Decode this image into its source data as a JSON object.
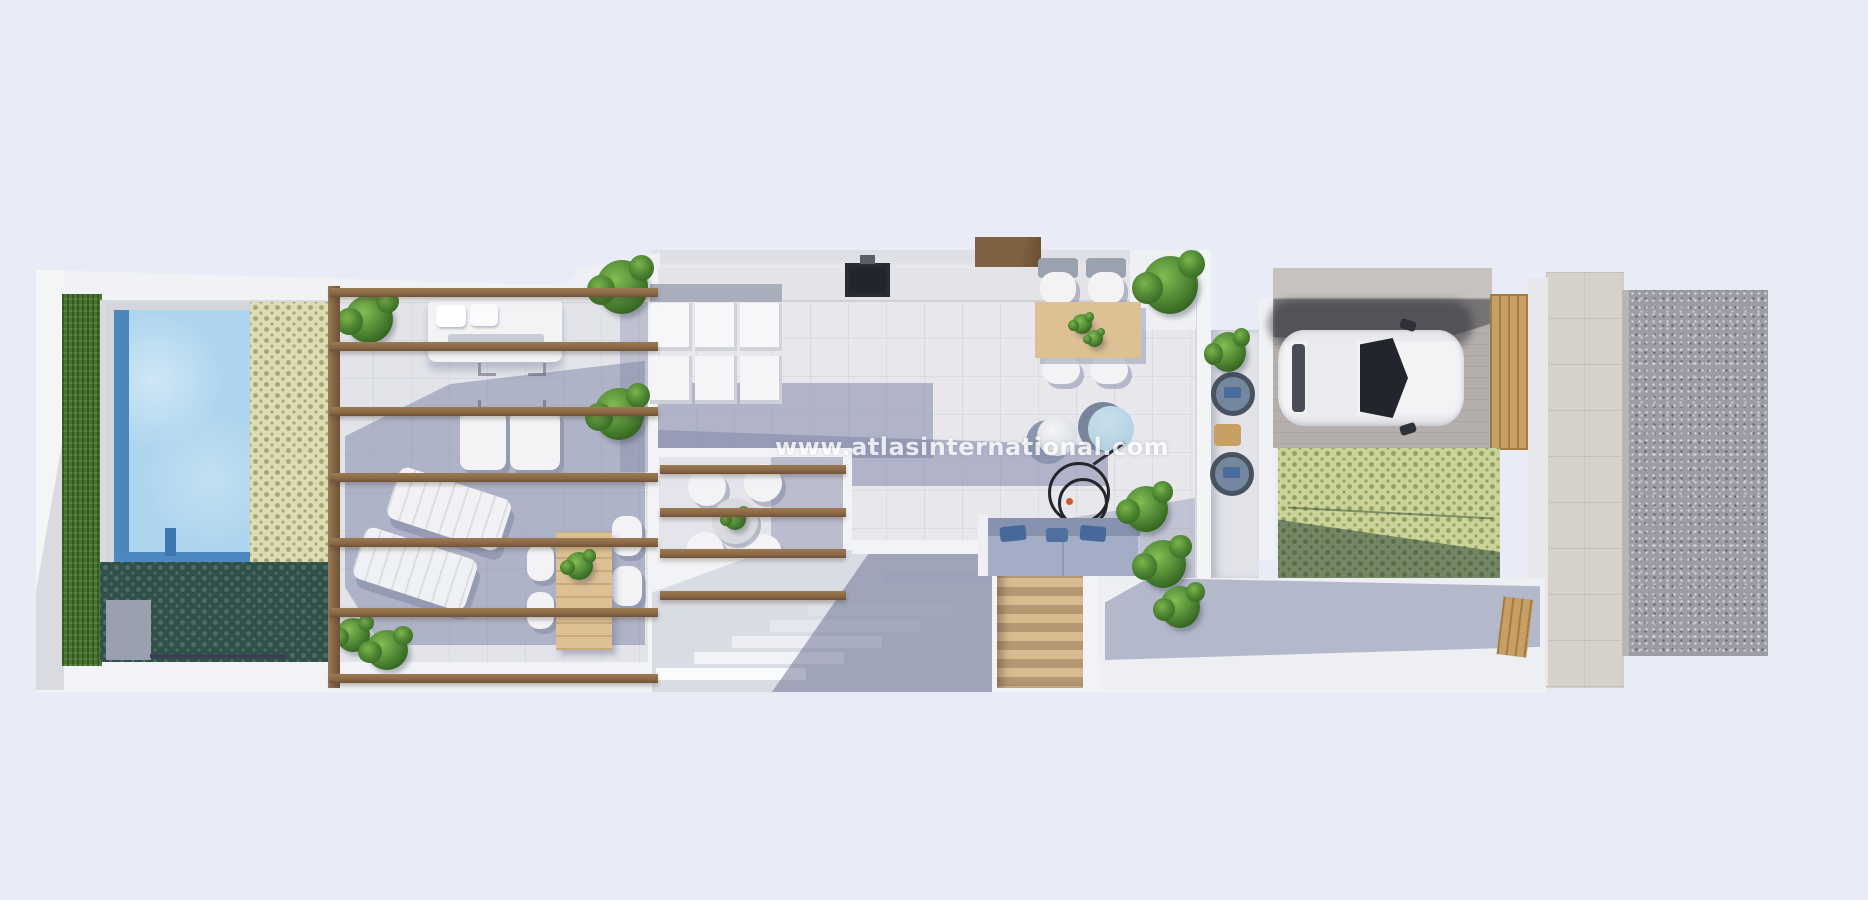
{
  "watermark": {
    "text": "www.atlasinternational.com"
  },
  "palette": {
    "background": "#e9ebf6",
    "wall_white": "#f2f3f6",
    "wall_shade": "#d9dbe2",
    "floor_light": "#e7e7ec",
    "terrace_floor": "#e3e4ea",
    "shadow_blue": "#7d85a8",
    "hedge_green": "#47742c",
    "pool_water": "#aed5ee",
    "pool_deep": "#4b86bd",
    "mosaic_light_base": "#dddcb2",
    "mosaic_light_dot": "#a3a974",
    "mosaic_dark_base": "#31504a",
    "mosaic_dark_dot": "#4c6e60",
    "mosaic_green_base": "#cbd39b",
    "mosaic_green_dot": "#8fa35c",
    "wood_beam": "#8a6845",
    "wood_table": "#ddc094",
    "wood_stair_light": "#d8bc90",
    "wood_stair_dark": "#b59872",
    "sofa_seat": "#a3adc6",
    "sofa_back": "#8792ae",
    "pillow_blue": "#47689b",
    "pouf_blue": "#b6d2e3",
    "car_body": "#f3f3f5",
    "car_glass": "#22252c",
    "carport_paving": "#b4afac",
    "gate_wood": "#c79f63",
    "sidewalk": "#d6d2ca",
    "road_gravel": "#9c9ca4",
    "watermark_white": "#ffffff"
  }
}
